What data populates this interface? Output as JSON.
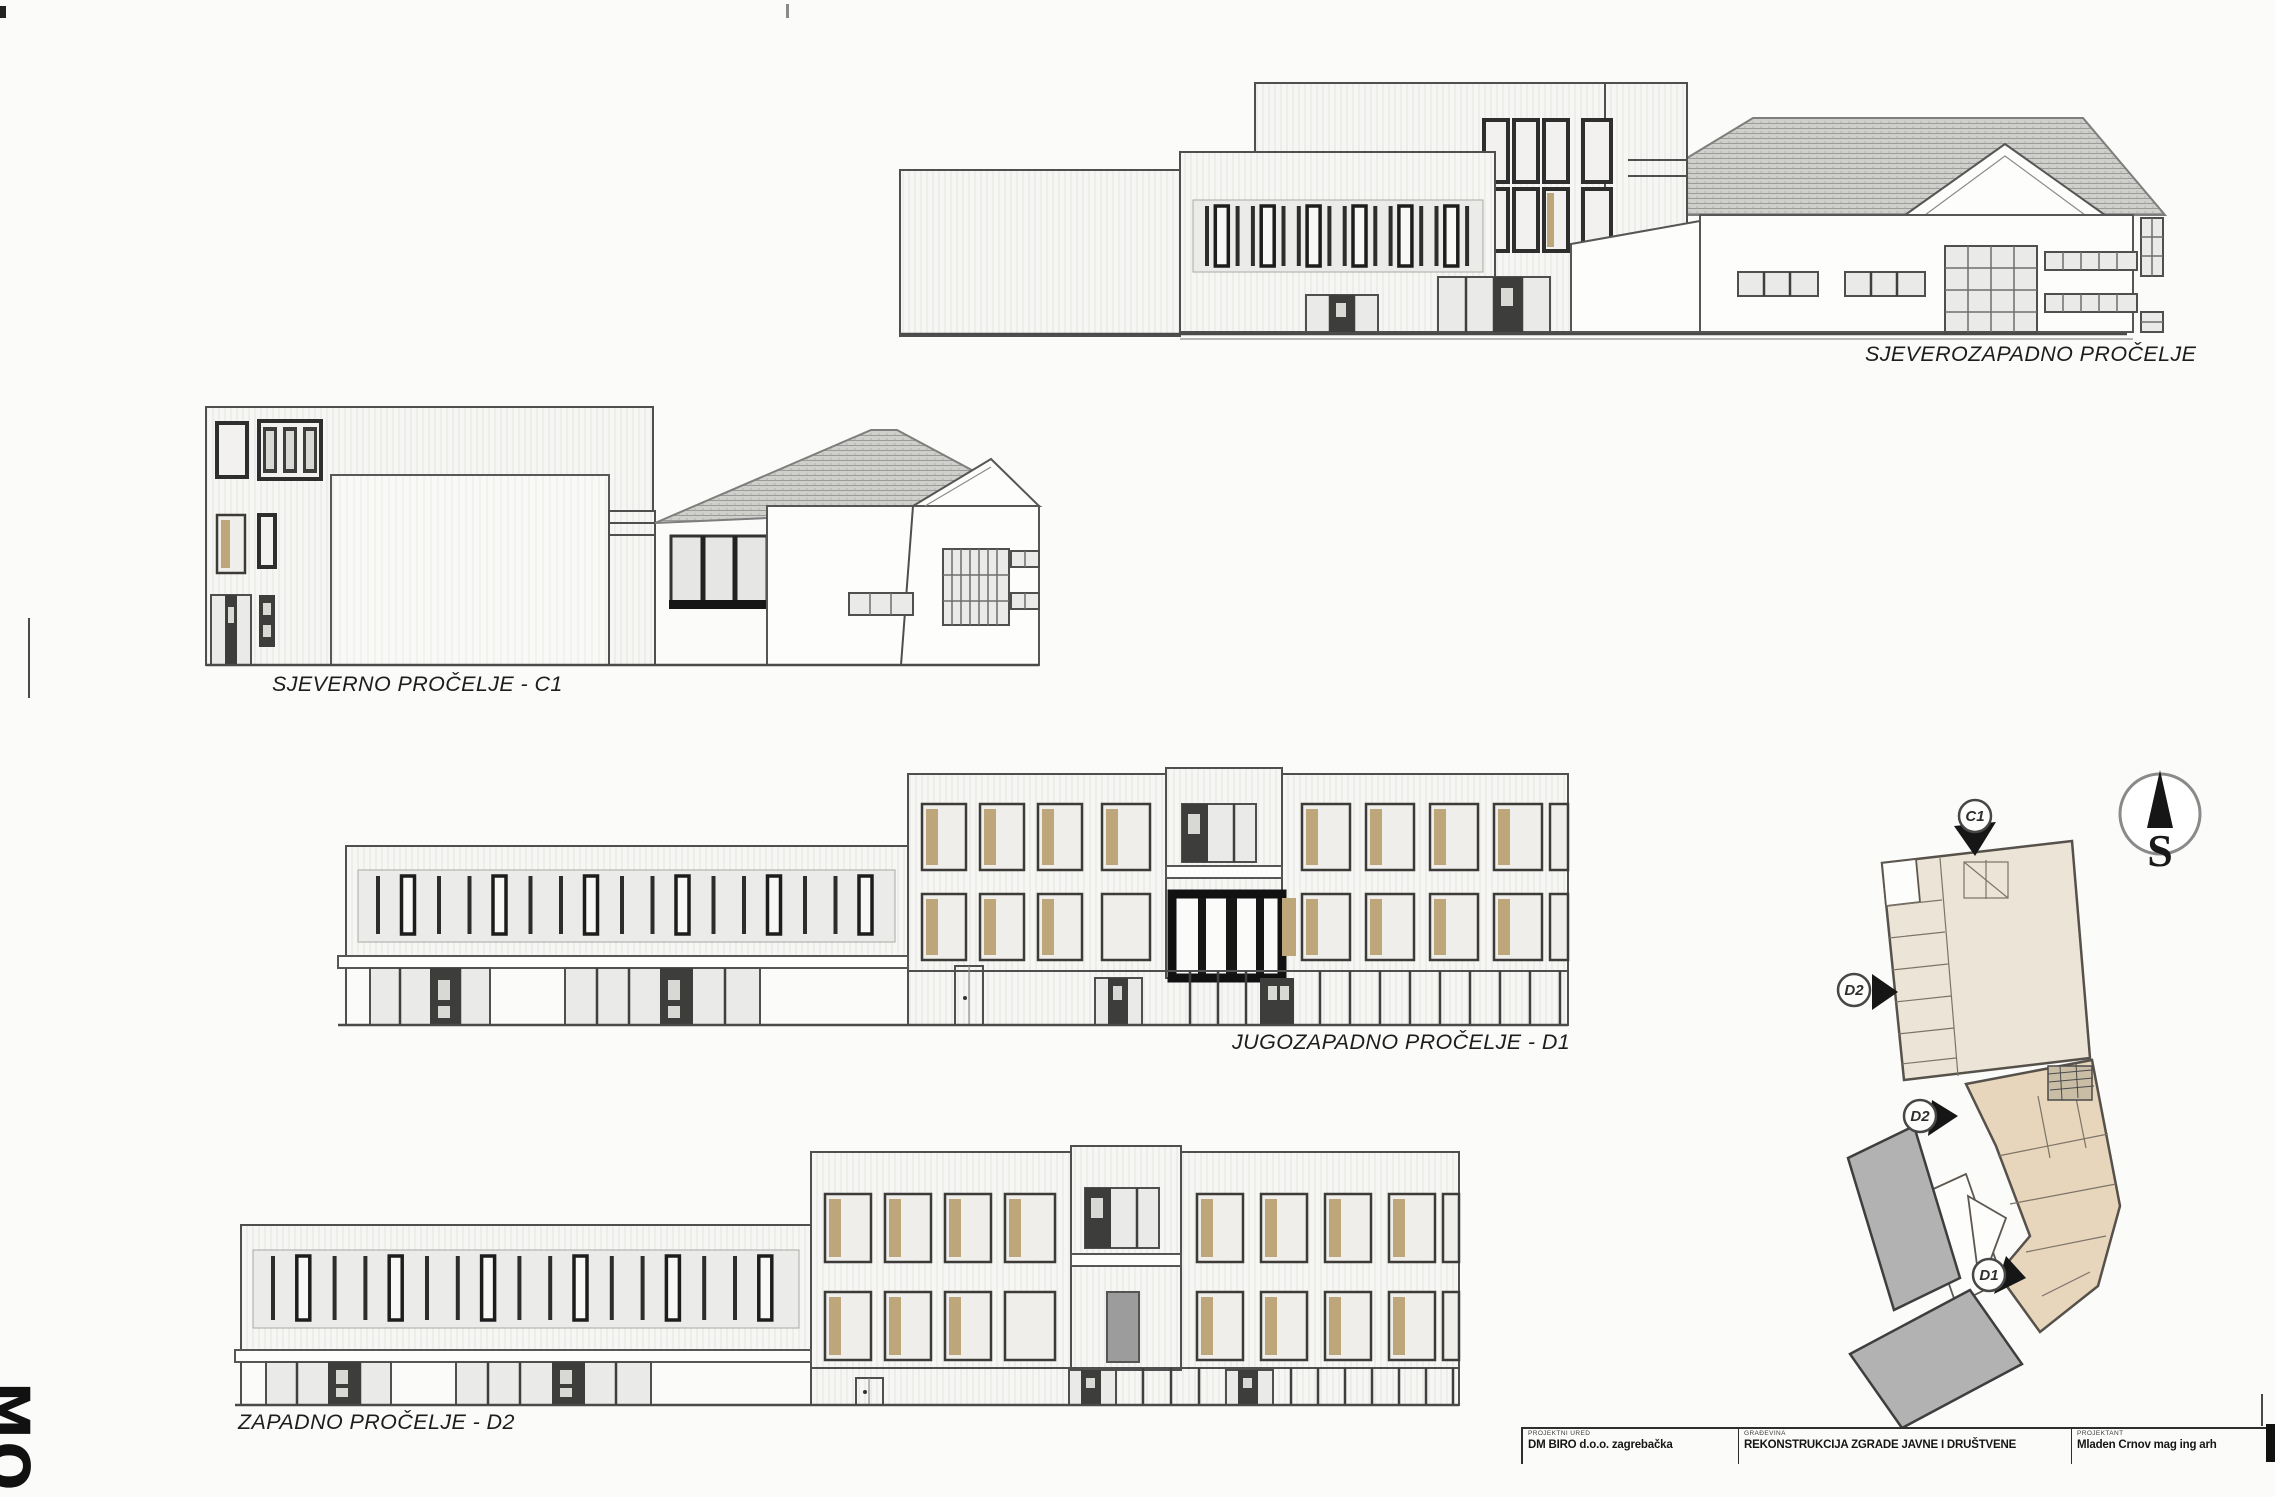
{
  "sheet": {
    "background": "#fbfbf9"
  },
  "palette": {
    "line": "#4f4f4f",
    "window_tan": "#bda77a",
    "roof_gray": "#cfcfcc",
    "plan_beige_upper": "#ece4d6",
    "plan_beige_lower": "#e7d6bb",
    "plan_gray": "#b2b2b2",
    "feature_black": "#161616"
  },
  "elevations": [
    {
      "id": "northwest",
      "label": "SJEVEROZAPADNO PROČELJE"
    },
    {
      "id": "north",
      "label": "SJEVERNO PROČELJE - C1"
    },
    {
      "id": "southwest",
      "label": "JUGOZAPADNO PROČELJE - D1"
    },
    {
      "id": "west",
      "label": "ZAPADNO PROČELJE - D2"
    }
  ],
  "site_plan": {
    "compass_letter": "S",
    "markers": [
      {
        "label": "C1"
      },
      {
        "label": "D2"
      },
      {
        "label": "D2"
      },
      {
        "label": "D1"
      }
    ]
  },
  "title_block": {
    "cells": [
      {
        "header": "PROJEKTNI URED",
        "value": "DM BIRO  d.o.o. zagrebačka"
      },
      {
        "header": "GRAĐEVINA",
        "value": "REKONSTRUKCIJA ZGRADE JAVNE I DRUŠTVENE"
      },
      {
        "header": "PROJEKTANT",
        "value": "Mladen Crnov mag ing arh"
      }
    ]
  },
  "corner_mark": "MO"
}
